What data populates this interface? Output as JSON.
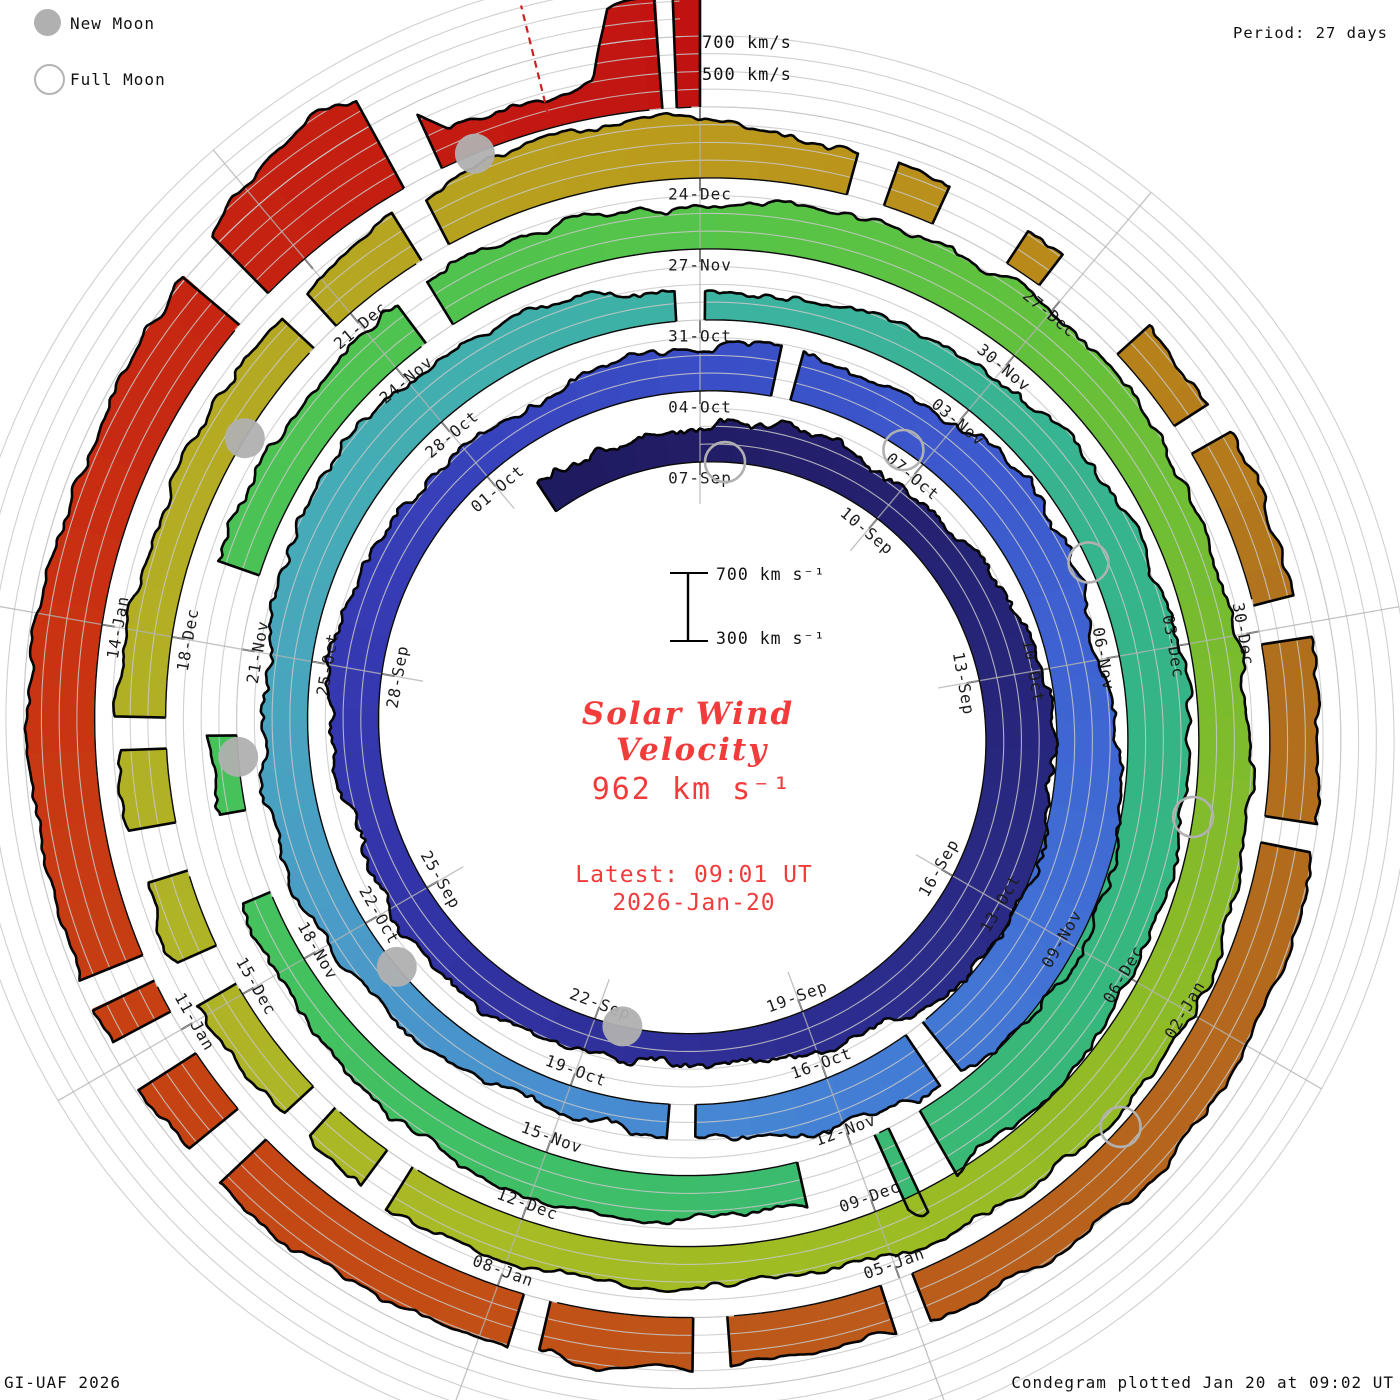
{
  "legend": {
    "new_moon": "New Moon",
    "full_moon": "Full Moon"
  },
  "header": {
    "period": "Period: 27 days"
  },
  "axis": {
    "grid_700": "700 km/s",
    "grid_500": "500 km/s",
    "scale_700": "700 km s⁻¹",
    "scale_300": "300 km s⁻¹"
  },
  "center": {
    "title_line1": "Solar Wind",
    "title_line2": "Velocity",
    "speed": "962 km s⁻¹",
    "latest_time": "Latest: 09:01 UT",
    "latest_date": "2026-Jan-20"
  },
  "footer": {
    "left": "GI-UAF 2026",
    "right": "Condegram plotted Jan 20 at 09:02 UT"
  },
  "chart_data": {
    "type": "spiral_polar_time_series_condegram",
    "title": "Solar Wind Velocity",
    "period_days": 27,
    "rotations": 5,
    "day0_label": "07-Sep",
    "end_label": "2026-Jan-20 09:01 UT",
    "velocity_axis_kms": [
      300,
      400,
      500,
      600,
      700
    ],
    "current_velocity_kms": 962,
    "radial_label_step_days": 3,
    "date_labels": [
      {
        "t": 0,
        "text": "07-Sep"
      },
      {
        "t": 3,
        "text": "10-Sep"
      },
      {
        "t": 6,
        "text": "13-Sep"
      },
      {
        "t": 9,
        "text": "16-Sep"
      },
      {
        "t": 12,
        "text": "19-Sep"
      },
      {
        "t": 15,
        "text": "22-Sep"
      },
      {
        "t": 18,
        "text": "25-Sep"
      },
      {
        "t": 21,
        "text": "28-Sep"
      },
      {
        "t": 24,
        "text": "01-Oct"
      },
      {
        "t": 27,
        "text": "04-Oct"
      },
      {
        "t": 30,
        "text": "07-Oct"
      },
      {
        "t": 33,
        "text": "10-Oct"
      },
      {
        "t": 36,
        "text": "13-Oct"
      },
      {
        "t": 39,
        "text": "16-Oct"
      },
      {
        "t": 42,
        "text": "19-Oct"
      },
      {
        "t": 45,
        "text": "22-Oct"
      },
      {
        "t": 48,
        "text": "25-Oct"
      },
      {
        "t": 51,
        "text": "28-Oct"
      },
      {
        "t": 54,
        "text": "31-Oct"
      },
      {
        "t": 57,
        "text": "03-Nov"
      },
      {
        "t": 60,
        "text": "06-Nov"
      },
      {
        "t": 63,
        "text": "09-Nov"
      },
      {
        "t": 66,
        "text": "12-Nov"
      },
      {
        "t": 69,
        "text": "15-Nov"
      },
      {
        "t": 72,
        "text": "18-Nov"
      },
      {
        "t": 75,
        "text": "21-Nov"
      },
      {
        "t": 78,
        "text": "24-Nov"
      },
      {
        "t": 81,
        "text": "27-Nov"
      },
      {
        "t": 84,
        "text": "30-Nov"
      },
      {
        "t": 87,
        "text": "03-Dec"
      },
      {
        "t": 90,
        "text": "06-Dec"
      },
      {
        "t": 93,
        "text": "09-Dec"
      },
      {
        "t": 96,
        "text": "12-Dec"
      },
      {
        "t": 99,
        "text": "15-Dec"
      },
      {
        "t": 102,
        "text": "18-Dec"
      },
      {
        "t": 105,
        "text": "21-Dec"
      },
      {
        "t": 108,
        "text": "24-Dec"
      },
      {
        "t": 111,
        "text": "27-Dec"
      },
      {
        "t": 114,
        "text": "30-Dec"
      },
      {
        "t": 117,
        "text": "02-Jan"
      },
      {
        "t": 120,
        "text": "05-Jan"
      },
      {
        "t": 123,
        "text": "08-Jan"
      },
      {
        "t": 126,
        "text": "11-Jan"
      },
      {
        "t": 129,
        "text": "14-Jan"
      }
    ],
    "velocity_anchors_day_kms": [
      [
        -2.5,
        470
      ],
      [
        0,
        500
      ],
      [
        1,
        540
      ],
      [
        2,
        545
      ],
      [
        3,
        520
      ],
      [
        4,
        560
      ],
      [
        5,
        610
      ],
      [
        6,
        640
      ],
      [
        7,
        680
      ],
      [
        8,
        710
      ],
      [
        9,
        720
      ],
      [
        10,
        670
      ],
      [
        11,
        600
      ],
      [
        12,
        545
      ],
      [
        13,
        500
      ],
      [
        14,
        465
      ],
      [
        15,
        480
      ],
      [
        16,
        520
      ],
      [
        17,
        555
      ],
      [
        18,
        540
      ],
      [
        19,
        525
      ],
      [
        20,
        560
      ],
      [
        21,
        595
      ],
      [
        22,
        575
      ],
      [
        23,
        540
      ],
      [
        24,
        510
      ],
      [
        25,
        490
      ],
      [
        26,
        520
      ],
      [
        27,
        545
      ],
      [
        28,
        575
      ],
      [
        29,
        550
      ],
      [
        30,
        600
      ],
      [
        31,
        640
      ],
      [
        32,
        605
      ],
      [
        33,
        580
      ],
      [
        34,
        650
      ],
      [
        35,
        720
      ],
      [
        36,
        740
      ],
      [
        37,
        695
      ],
      [
        38,
        635
      ],
      [
        39,
        570
      ],
      [
        40,
        510
      ],
      [
        41,
        470
      ],
      [
        42,
        455
      ],
      [
        43,
        475
      ],
      [
        44,
        500
      ],
      [
        45,
        540
      ],
      [
        46,
        575
      ],
      [
        47,
        560
      ],
      [
        48,
        540
      ],
      [
        49,
        580
      ],
      [
        50,
        615
      ],
      [
        51,
        600
      ],
      [
        52,
        560
      ],
      [
        53,
        520
      ],
      [
        54,
        445
      ],
      [
        55,
        470
      ],
      [
        56,
        510
      ],
      [
        57,
        550
      ],
      [
        58,
        590
      ],
      [
        59,
        615
      ],
      [
        60,
        640
      ],
      [
        61,
        655
      ],
      [
        62,
        645
      ],
      [
        63,
        670
      ],
      [
        64,
        695
      ],
      [
        65,
        655
      ],
      [
        65.65,
        820
      ],
      [
        66,
        575
      ],
      [
        67,
        545
      ],
      [
        68,
        560
      ],
      [
        69,
        575
      ],
      [
        70,
        540
      ],
      [
        71,
        505
      ],
      [
        72,
        480
      ],
      [
        73,
        455
      ],
      [
        73.8,
        430
      ],
      [
        75,
        515
      ],
      [
        76,
        550
      ],
      [
        77,
        535
      ],
      [
        78,
        550
      ],
      [
        79,
        575
      ],
      [
        80,
        560
      ],
      [
        81,
        545
      ],
      [
        82,
        585
      ],
      [
        83,
        620
      ],
      [
        84,
        640
      ],
      [
        85,
        615
      ],
      [
        86,
        580
      ],
      [
        87,
        560
      ],
      [
        88,
        600
      ],
      [
        89,
        640
      ],
      [
        90,
        660
      ],
      [
        91,
        640
      ],
      [
        92,
        605
      ],
      [
        93,
        560
      ],
      [
        94,
        515
      ],
      [
        95,
        525
      ],
      [
        96,
        540
      ],
      [
        97,
        555
      ],
      [
        98,
        530
      ],
      [
        99,
        540
      ],
      [
        100,
        555
      ],
      [
        101,
        575
      ],
      [
        102,
        560
      ],
      [
        103,
        540
      ],
      [
        104,
        525
      ],
      [
        105,
        560
      ],
      [
        106,
        615
      ],
      [
        107,
        650
      ],
      [
        108,
        620
      ],
      [
        109,
        560
      ],
      [
        110,
        525
      ],
      [
        111,
        505
      ],
      [
        112,
        520
      ],
      [
        113,
        540
      ],
      [
        114,
        555
      ],
      [
        115,
        575
      ],
      [
        116,
        595
      ],
      [
        117,
        615
      ],
      [
        118,
        635
      ],
      [
        119,
        600
      ],
      [
        120,
        575
      ],
      [
        121,
        560
      ],
      [
        122,
        595
      ],
      [
        123,
        620
      ],
      [
        124,
        640
      ],
      [
        125,
        655
      ],
      [
        126,
        670
      ],
      [
        127,
        690
      ],
      [
        128,
        680
      ],
      [
        129,
        660
      ],
      [
        130,
        640
      ],
      [
        131,
        690
      ],
      [
        131.8,
        780
      ],
      [
        132.3,
        880
      ],
      [
        132.7,
        900
      ],
      [
        133,
        800
      ],
      [
        133.3,
        470
      ],
      [
        134,
        480
      ],
      [
        134.3,
        520
      ],
      [
        134.45,
        880
      ],
      [
        134.65,
        940
      ],
      [
        135,
        962
      ]
    ],
    "data_gaps_days": [
      [
        27.9,
        28.15
      ],
      [
        37.7,
        37.95
      ],
      [
        40.55,
        40.85
      ],
      [
        53.75,
        54.05
      ],
      [
        65.25,
        65.6
      ],
      [
        65.75,
        66.55
      ],
      [
        72.7,
        73.5
      ],
      [
        74.2,
        75.7
      ],
      [
        78.35,
        78.65
      ],
      [
        97.0,
        97.25
      ],
      [
        97.8,
        98.05
      ],
      [
        99.1,
        99.45
      ],
      [
        100.1,
        100.5
      ],
      [
        101.1,
        101.35
      ],
      [
        104.6,
        104.85
      ],
      [
        105.7,
        105.95
      ],
      [
        109.15,
        109.45
      ],
      [
        109.85,
        110.5
      ],
      [
        110.8,
        111.6
      ],
      [
        112.3,
        112.55
      ],
      [
        113.8,
        114.1
      ],
      [
        115.4,
        115.6
      ],
      [
        119.9,
        120.15
      ],
      [
        121.3,
        121.55
      ],
      [
        122.6,
        122.8
      ],
      [
        125.0,
        125.3
      ],
      [
        125.8,
        126.15
      ],
      [
        126.4,
        126.6
      ],
      [
        131.35,
        131.65
      ],
      [
        132.85,
        133.15
      ],
      [
        134.74,
        134.84
      ]
    ],
    "new_moons_day": [
      14.6,
      44.4,
      74.0,
      103.7,
      133.4
    ],
    "full_moons_day": [
      0.4,
      29.7,
      59.0,
      88.5,
      118.0
    ],
    "colormap_day_hex": [
      [
        -3,
        "#1e1a5e"
      ],
      [
        0,
        "#221d66"
      ],
      [
        6,
        "#262579"
      ],
      [
        9,
        "#2a2a85"
      ],
      [
        15,
        "#30309c"
      ],
      [
        21,
        "#3538b0"
      ],
      [
        24,
        "#3742bb"
      ],
      [
        27,
        "#3a4ec6"
      ],
      [
        30,
        "#3c58cc"
      ],
      [
        33,
        "#3e62d1"
      ],
      [
        36,
        "#4170d4"
      ],
      [
        39,
        "#4480d4"
      ],
      [
        42,
        "#488ed0"
      ],
      [
        45,
        "#4a9bc7"
      ],
      [
        48,
        "#48a7bd"
      ],
      [
        51,
        "#42aeb0"
      ],
      [
        54,
        "#3cb2a2"
      ],
      [
        57,
        "#38b494"
      ],
      [
        60,
        "#35b489"
      ],
      [
        63,
        "#36b77e"
      ],
      [
        66,
        "#3aba70"
      ],
      [
        69,
        "#3fbf66"
      ],
      [
        72,
        "#44c15e"
      ],
      [
        75,
        "#49c257"
      ],
      [
        78,
        "#4ec350"
      ],
      [
        81,
        "#55c44a"
      ],
      [
        84,
        "#62c13c"
      ],
      [
        87,
        "#78bc2f"
      ],
      [
        90,
        "#8dbb28"
      ],
      [
        93,
        "#9cbc23"
      ],
      [
        96,
        "#a7bb24"
      ],
      [
        99,
        "#aeb426"
      ],
      [
        102,
        "#b2af25"
      ],
      [
        105,
        "#b5a721"
      ],
      [
        108,
        "#ba9a1c"
      ],
      [
        111,
        "#b9881a"
      ],
      [
        114,
        "#b0701d"
      ],
      [
        117,
        "#b4681d"
      ],
      [
        120,
        "#ba5c1b"
      ],
      [
        123,
        "#c24f16"
      ],
      [
        126,
        "#c64113"
      ],
      [
        129,
        "#c93212"
      ],
      [
        132,
        "#c52111"
      ],
      [
        135,
        "#c01311"
      ]
    ],
    "layout": {
      "center_px": [
        700,
        730
      ],
      "base_radius_px": 268,
      "radius_per_rotation_px": 71,
      "px_per_100kms": 17.75,
      "grid_spiral_turns": 6,
      "spoke_every_deg": 40
    },
    "marker": {
      "red_dashed_line_day": 133.96
    },
    "status_colors": {
      "annotation_red": "#f23b3b",
      "moon_gray": "#b0b0b0"
    }
  }
}
